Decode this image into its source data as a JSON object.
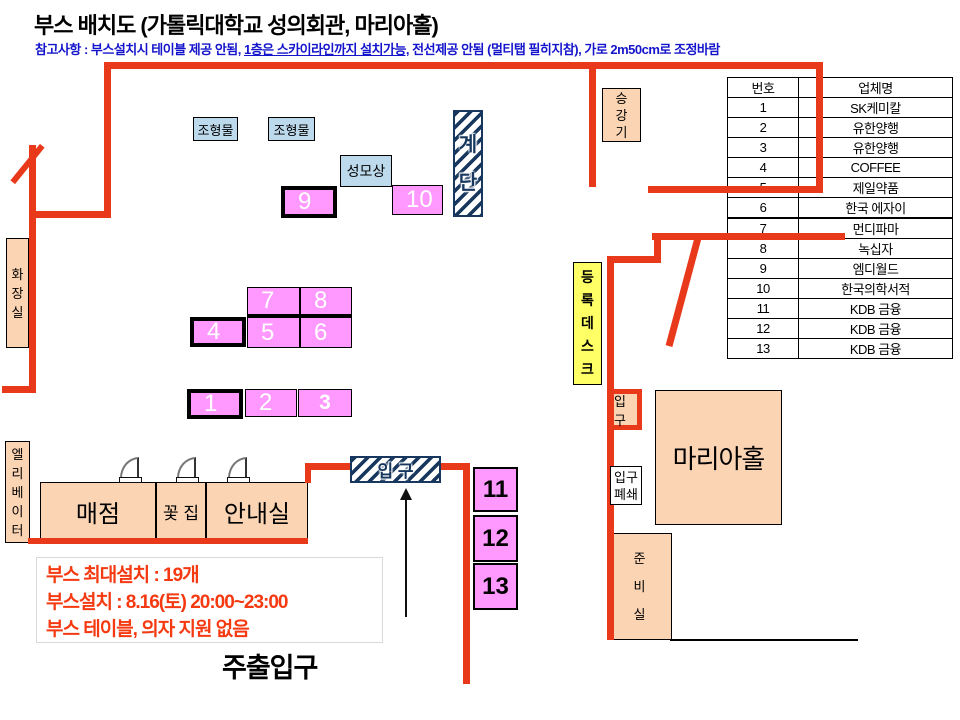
{
  "header": {
    "title": "부스 배치도 (가톨릭대학교 성의회관, 마리아홀)",
    "note": {
      "prefix": "참고사항 : 부스설치시 테이블 제공 안됨, ",
      "underlined": "1층은 스카이라인까지 설치가능,",
      "mid": " 전선제공 안됨 ",
      "bold": "(멀티탭 필히지참)",
      "suffix": ", 가로 2m50cm로 조정바람"
    }
  },
  "company_table": {
    "headers": {
      "no": "번호",
      "name": "업체명"
    },
    "rows": [
      {
        "no": "1",
        "name": "SK케미칼"
      },
      {
        "no": "2",
        "name": "유한양행"
      },
      {
        "no": "3",
        "name": "유한양행"
      },
      {
        "no": "4",
        "name": "COFFEE"
      },
      {
        "no": "5",
        "name": "제일약품"
      },
      {
        "no": "6",
        "name": "한국 에자이"
      },
      {
        "no": "7",
        "name": "먼디파마"
      },
      {
        "no": "8",
        "name": "녹십자"
      },
      {
        "no": "9",
        "name": "엠디월드"
      },
      {
        "no": "10",
        "name": "한국의학서적"
      },
      {
        "no": "11",
        "name": "KDB 금융"
      },
      {
        "no": "12",
        "name": "KDB 금융"
      },
      {
        "no": "13",
        "name": "KDB 금융"
      }
    ]
  },
  "map": {
    "booths": [
      "1",
      "2",
      "3",
      "4",
      "5",
      "6",
      "7",
      "8",
      "9",
      "10",
      "11",
      "12",
      "13"
    ],
    "labels": {
      "sculpture": "조형물",
      "mary_statue": "성모상",
      "stairs": "계단",
      "elevator_top": "승강기",
      "restroom": "화장실",
      "registration_desk": "등록데스크",
      "entrance_red": "입구",
      "entrance_hatched": "입 구",
      "entrance_closed": "입구\n폐쇄",
      "maria_hall": "마리아홀",
      "prep_room": "준비실",
      "elevator_left": "엘리베이터",
      "store": "매점",
      "flower_shop": "꽃 집",
      "info_room": "안내실",
      "main_entrance": "주출입구"
    }
  },
  "notice": {
    "line1": "부스 최대설치 : 19개",
    "line2": "부스설치 : 8.16(토) 20:00~23:00",
    "line3": "부스 테이블, 의자 지원 없음"
  },
  "colors": {
    "wall": "#E8391B",
    "booth_pink": "#FF99FF",
    "room_peach": "#FBD4B4",
    "object_blue": "#BDD9EC",
    "desk_yellow": "#FFFF66",
    "note_blue": "#1414CC",
    "notice_red": "#F53A12",
    "hatch_navy": "#17375E"
  }
}
